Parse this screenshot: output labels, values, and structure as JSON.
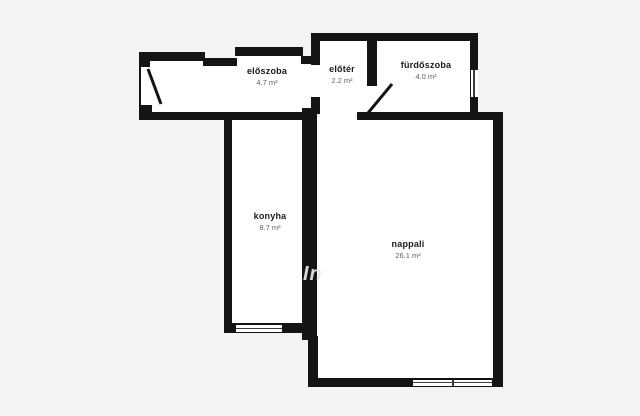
{
  "plan": {
    "title": "apartment-floorplan",
    "colors": {
      "background": "#f3f3f1",
      "wall": "#141414",
      "floor": "#ffffff",
      "room_name": "#1b1b1b",
      "room_area": "#5f5f5f"
    },
    "watermark": "In",
    "rooms": [
      {
        "id": "eloszoba",
        "name": "előszoba",
        "area": "4.7 m²"
      },
      {
        "id": "eloter",
        "name": "előtér",
        "area": "2.2 m²"
      },
      {
        "id": "furdoszoba",
        "name": "fürdőszoba",
        "area": "4.0 m²"
      },
      {
        "id": "konyha",
        "name": "konyha",
        "area": "8.7 m²"
      },
      {
        "id": "nappali",
        "name": "nappali",
        "area": "26.1 m²"
      }
    ],
    "symbols": {
      "door_swings": 2,
      "windows": 3
    }
  }
}
